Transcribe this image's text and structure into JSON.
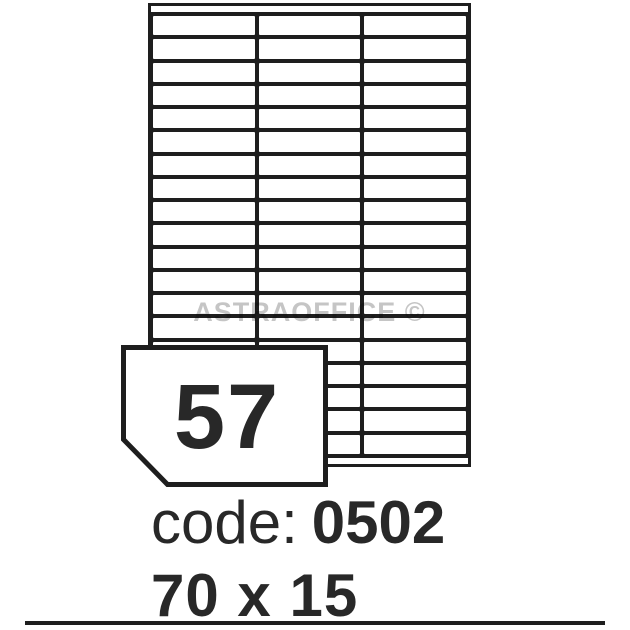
{
  "image": {
    "watermark": "ASTRAOFFICE ©"
  },
  "sheet": {
    "rows": 19,
    "columns": 3,
    "labels_total": 57
  },
  "badge": {
    "count": "57"
  },
  "caption": {
    "code_label": "code:",
    "code_value": "0502",
    "size": "70 x 15"
  },
  "colors": {
    "line": "#1e1e1e",
    "text": "#282828",
    "watermark": "#c5c5c5"
  }
}
